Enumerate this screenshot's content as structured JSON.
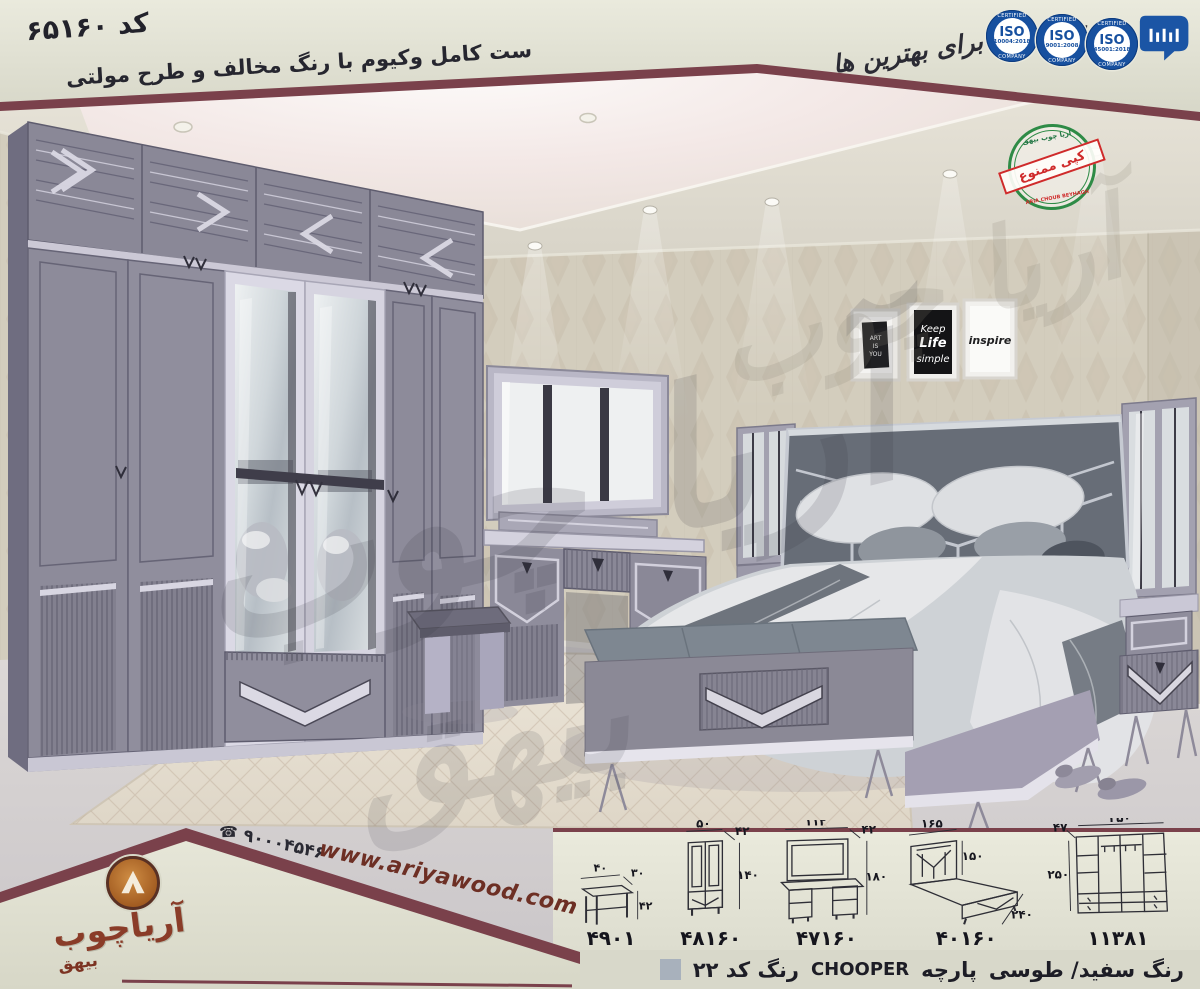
{
  "header": {
    "code": "کد ۶۵۱۶۰",
    "subtitle": "ست کامل وکیوم با رنگ مخالف و طرح مولتی",
    "slogan": "برترین ها برای بهترین ها",
    "iso_badges": [
      {
        "name": "ISO",
        "std": "10004:2018",
        "top": "CERTIFIED",
        "bottom": "COMPANY"
      },
      {
        "name": "ISO",
        "std": "9001:2008",
        "top": "CERTIFIED",
        "bottom": "COMPANY"
      },
      {
        "name": "ISO",
        "std": "45001:2018",
        "top": "CERTIFIED",
        "bottom": "COMPANY"
      }
    ]
  },
  "stamp": {
    "top": "آریا چوب بیهق",
    "middle": "کپی ممنوع",
    "bottom": "ARIA CHOUB BEYHAGH"
  },
  "wall_art": {
    "frame1_line1": "ART",
    "frame1_line2": "IS",
    "frame1_line3": "YOU",
    "frame2_line1": "Keep",
    "frame2_line2": "Life",
    "frame2_line3": "simple",
    "frame3": "inspire"
  },
  "watermark": {
    "line1": "آریا چوب",
    "line2": "بیهق"
  },
  "footer": {
    "phone": "۹۰۰۰۴۵۴۶",
    "website": "www.ariyawood.com",
    "brand": "آریاچوب",
    "brand_sub": "بیهق",
    "color_note": {
      "colors": "رنگ سفید/ طوسی",
      "fabric_label": "پارچه",
      "fabric_name": "CHOOPER",
      "code_label": "رنگ کد ۲۲"
    },
    "swatch_color": "#a8b1bc",
    "items": [
      {
        "code": "۴۹۰۱",
        "dims": {
          "w": "۴۰",
          "d": "۳۰",
          "h": "۴۲"
        }
      },
      {
        "code": "۴۸۱۶۰",
        "dims": {
          "w": "۵۰",
          "d": "۴۲",
          "h": "۱۴۰"
        }
      },
      {
        "code": "۴۷۱۶۰",
        "dims": {
          "w": "۱۱۲",
          "d": "۴۲",
          "h": "۱۸۰"
        }
      },
      {
        "code": "۴۰۱۶۰",
        "dims": {
          "w": "۱۶۵",
          "h": "۱۵۰",
          "l": "۲۴۰"
        }
      },
      {
        "code": "۱۱۳۸۱",
        "dims": {
          "w": "۲۵۰",
          "d": "۴۷",
          "h": "۲۵۰"
        }
      }
    ]
  },
  "colors": {
    "maroon": "#7a414b",
    "cream_band": "#e2e2d5",
    "brand_brown": "#8a3c28",
    "badge_blue": "#17509f",
    "stamp_green": "#2e8b46",
    "stamp_red": "#cf2b2b",
    "furniture_gray": "#8f8d9c",
    "fabric_gray": "#676d77"
  }
}
